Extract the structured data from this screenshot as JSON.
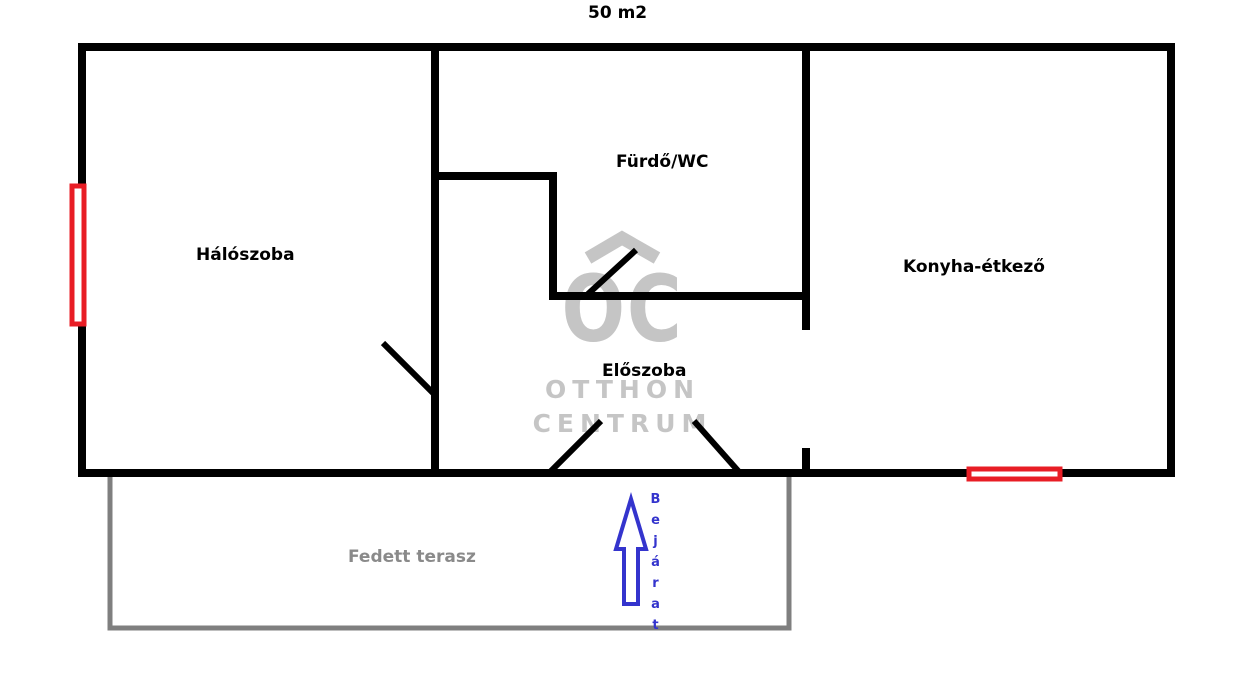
{
  "title": "50 m2",
  "rooms": {
    "bedroom": {
      "label": "Hálószoba"
    },
    "bathroom": {
      "label": "Fürdő/WC"
    },
    "kitchen": {
      "label": "Konyha-étkező"
    },
    "hallway": {
      "label": "Előszoba"
    },
    "terrace": {
      "label": "Fedett terasz"
    }
  },
  "entrance": {
    "label": "Bejárat"
  },
  "watermark": {
    "logo_text": "OC",
    "line1": "OTTHON",
    "line2": "CENTRUM"
  },
  "colors": {
    "wall": "#000000",
    "window": "#e81d25",
    "terrace": "#7f7f7f",
    "terrace_label": "#8a8a8a",
    "arrow": "#3434cd",
    "watermark": "#c5c5c5"
  }
}
